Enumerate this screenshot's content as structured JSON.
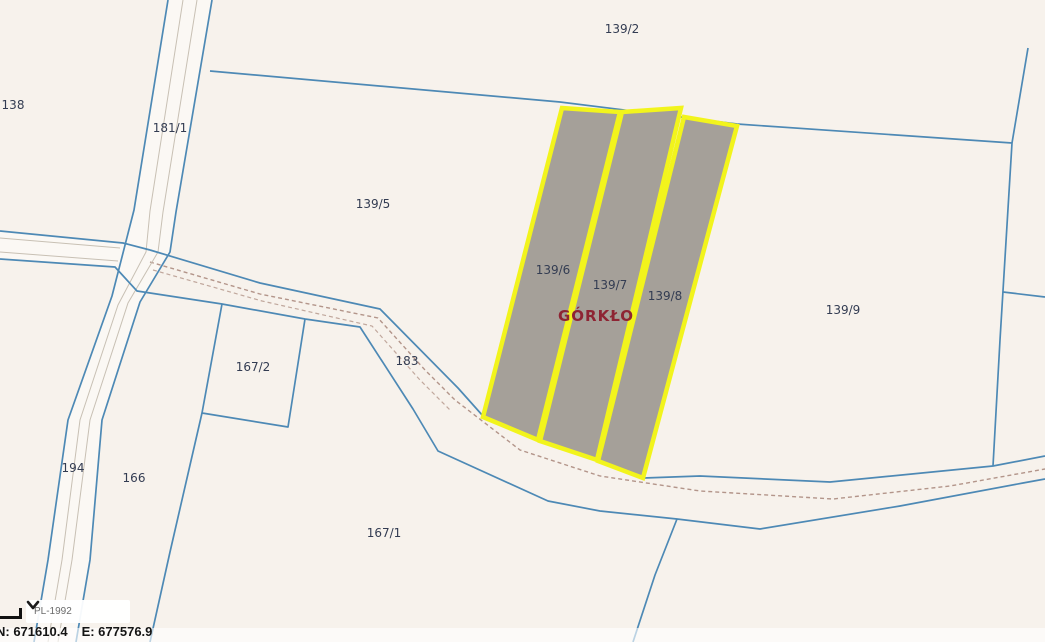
{
  "map": {
    "parcel_labels": [
      "138",
      "181/1",
      "139/2",
      "139/5",
      "139/6",
      "139/7",
      "139/8",
      "139/9",
      "167/2",
      "183",
      "194",
      "166",
      "167/1"
    ],
    "place_label": "GÓRKŁO",
    "selected_parcels": [
      "139/6",
      "139/7",
      "139/8"
    ],
    "colors": {
      "background": "#f7f2ec",
      "boundary_blue": "#4d89b5",
      "selection_outline_yellow": "#f2f41c",
      "selection_fill_gray": "#a5a099",
      "parcel_label_text": "#333c52",
      "place_label_red": "#8e2433",
      "dirt_track_dash": "#b3958a"
    }
  },
  "statusbar": {
    "crs_selector": {
      "value": "PL-1992",
      "icon": "chevron-down-icon"
    },
    "coordinates": {
      "north": "N: 671610.4",
      "east": "E: 677576.9"
    }
  }
}
